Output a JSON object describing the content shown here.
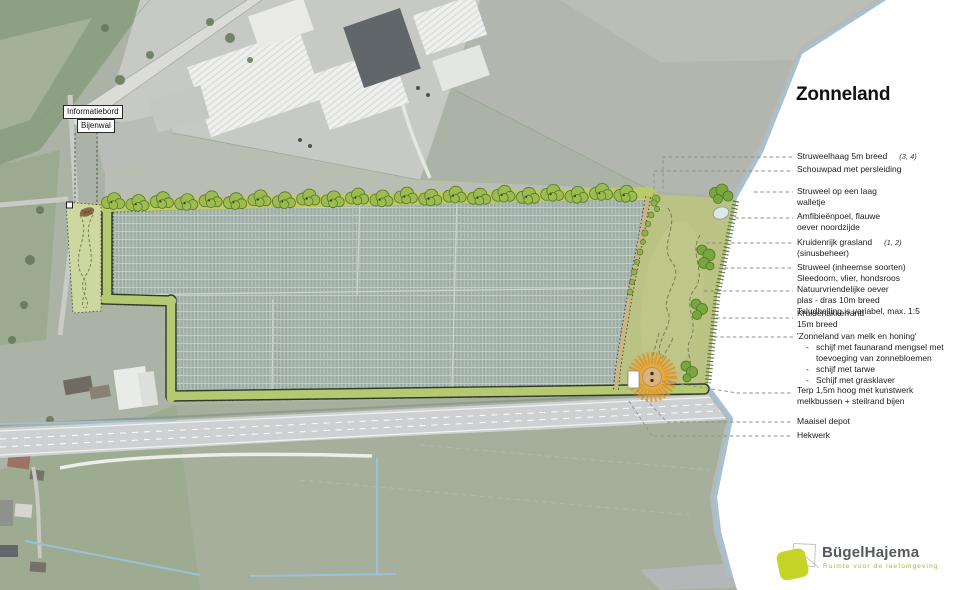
{
  "title": "Zonneland",
  "map_labels": {
    "informatiebord": "Informatiebord",
    "bijenwal": "Bijenwal"
  },
  "annotations": [
    {
      "lines": [
        "Struweelhaag 5m breed"
      ],
      "ref": "(3, 4)"
    },
    {
      "lines": [
        "Schouwpad met persleiding"
      ]
    },
    {
      "lines": [
        "Struweel op een laag",
        "walletje"
      ]
    },
    {
      "lines": [
        "Amfibieënpoel, flauwe",
        "oever noordzijde"
      ]
    },
    {
      "lines": [
        "Kruidenrijk grasland",
        "(sinusbeheer)"
      ],
      "ref": "(1, 2)"
    },
    {
      "lines": [
        "Struweel (inheemse soorten)",
        "Sleedoorn, vlier, hondsroos"
      ]
    },
    {
      "lines": [
        "Natuurvriendelijke oever",
        "plas - dras 10m breed",
        "Taludhelling is variabel, max. 1:5"
      ]
    },
    {
      "lines": [
        "Kruidenakkerrand",
        "15m breed"
      ]
    },
    {
      "lines": [
        "'Zonneland van melk en honing'"
      ],
      "bullet_char": "-",
      "bullets": [
        [
          "schijf met faunarand mengsel met",
          "toevoeging van zonnebloemen"
        ],
        [
          "schijf met tarwe"
        ],
        [
          "Schijf met grasklaver"
        ]
      ]
    },
    {
      "lines": [
        "Terp 1,5m hoog met kunstwerk",
        "melkbussen + steilrand bijen"
      ]
    },
    {
      "lines": [
        "Maaisel depot"
      ]
    },
    {
      "lines": [
        "Hekwerk"
      ]
    }
  ],
  "logo": {
    "name": "BügelHajema",
    "tagline": "Ruimte voor de leefomgeving"
  },
  "colors": {
    "site_border_green": "#b5c973",
    "hedge_tree_green": "#9dbb4f",
    "panel_gray_green": "#a9b8b0",
    "nature_green": "#bac284",
    "terp_orange": "#e8a93c",
    "water_blue": "#a4c2d2",
    "logo_green": "#c5d426"
  }
}
